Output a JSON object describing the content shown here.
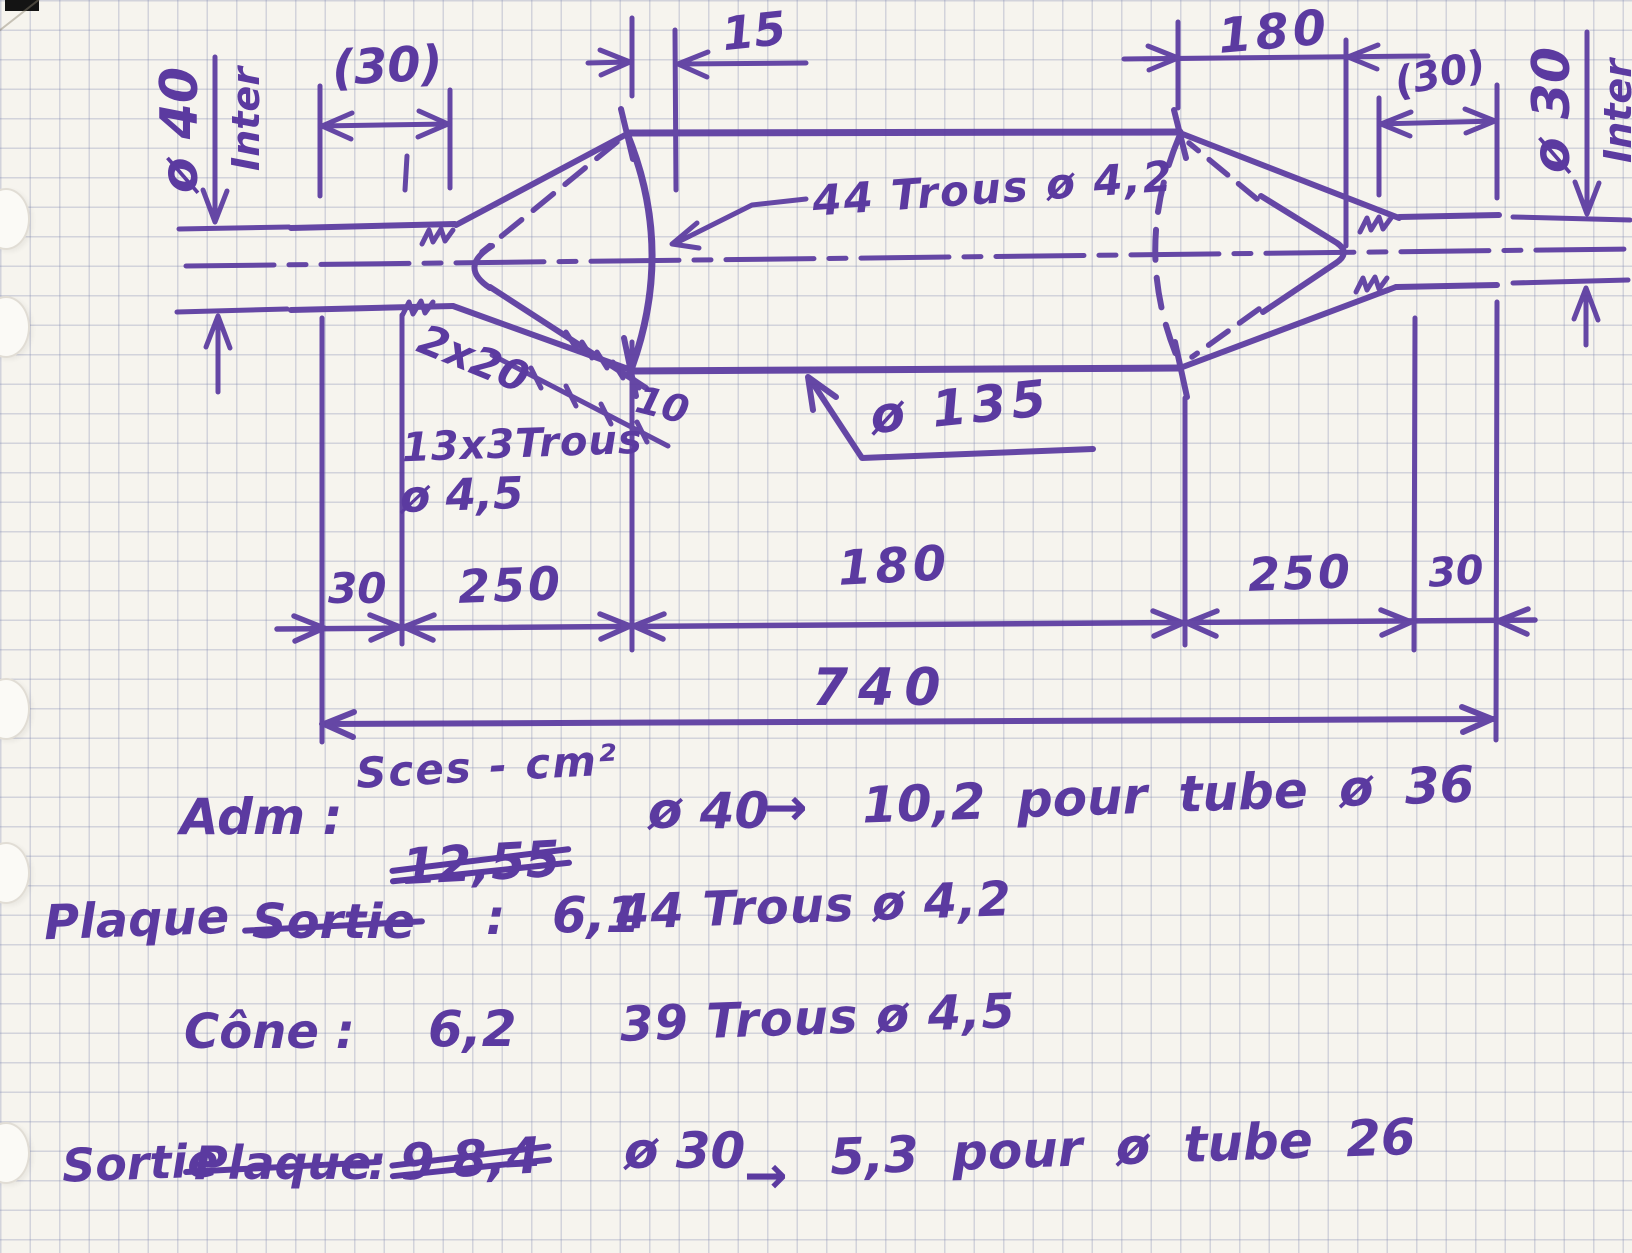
{
  "palette": {
    "ink": "#5b3aa0",
    "paper": "#f6f4ee",
    "grid": "#7d87af"
  },
  "dims": {
    "dia40": "ø 40",
    "inter_left": "Inter",
    "paren30_left": "(30)",
    "d15": "15",
    "holes44": "44 Trous ø 4,2",
    "d180_top": "180",
    "paren30_right": "(30)",
    "dia30": "ø 30",
    "inter_right": "Inter",
    "spacing2x20": "2x20",
    "d10": "10",
    "holes13x3": "13x3Trous",
    "dia45": "ø 4,5",
    "dia135": "ø 135",
    "b30_left": "30",
    "b250_left": "250",
    "b180": "180",
    "b250_right": "250",
    "b30_right": "30",
    "b740": "740"
  },
  "notes": {
    "header": "Sces - cm²",
    "row1": {
      "label": "Adm :",
      "struck_value": "12,55",
      "dia": "ø 40",
      "arrow": "→",
      "rest": "10,2 pour tube ø 36"
    },
    "row2": {
      "keep": "Plaque",
      "struck": "Sortie",
      "colon": ":",
      "value": "6,1",
      "desc": "44 Trous ø 4,2"
    },
    "row3": {
      "label": "Cône :",
      "value": "6,2",
      "desc": "39 Trous ø 4,5"
    },
    "row4": {
      "keep": "Sortie",
      "struck": "Plaque",
      "colon": ":",
      "struck_value": "9 8,4",
      "dia": "ø 30",
      "arrow": "→",
      "rest": "5,3 pour ø tube 26"
    }
  }
}
